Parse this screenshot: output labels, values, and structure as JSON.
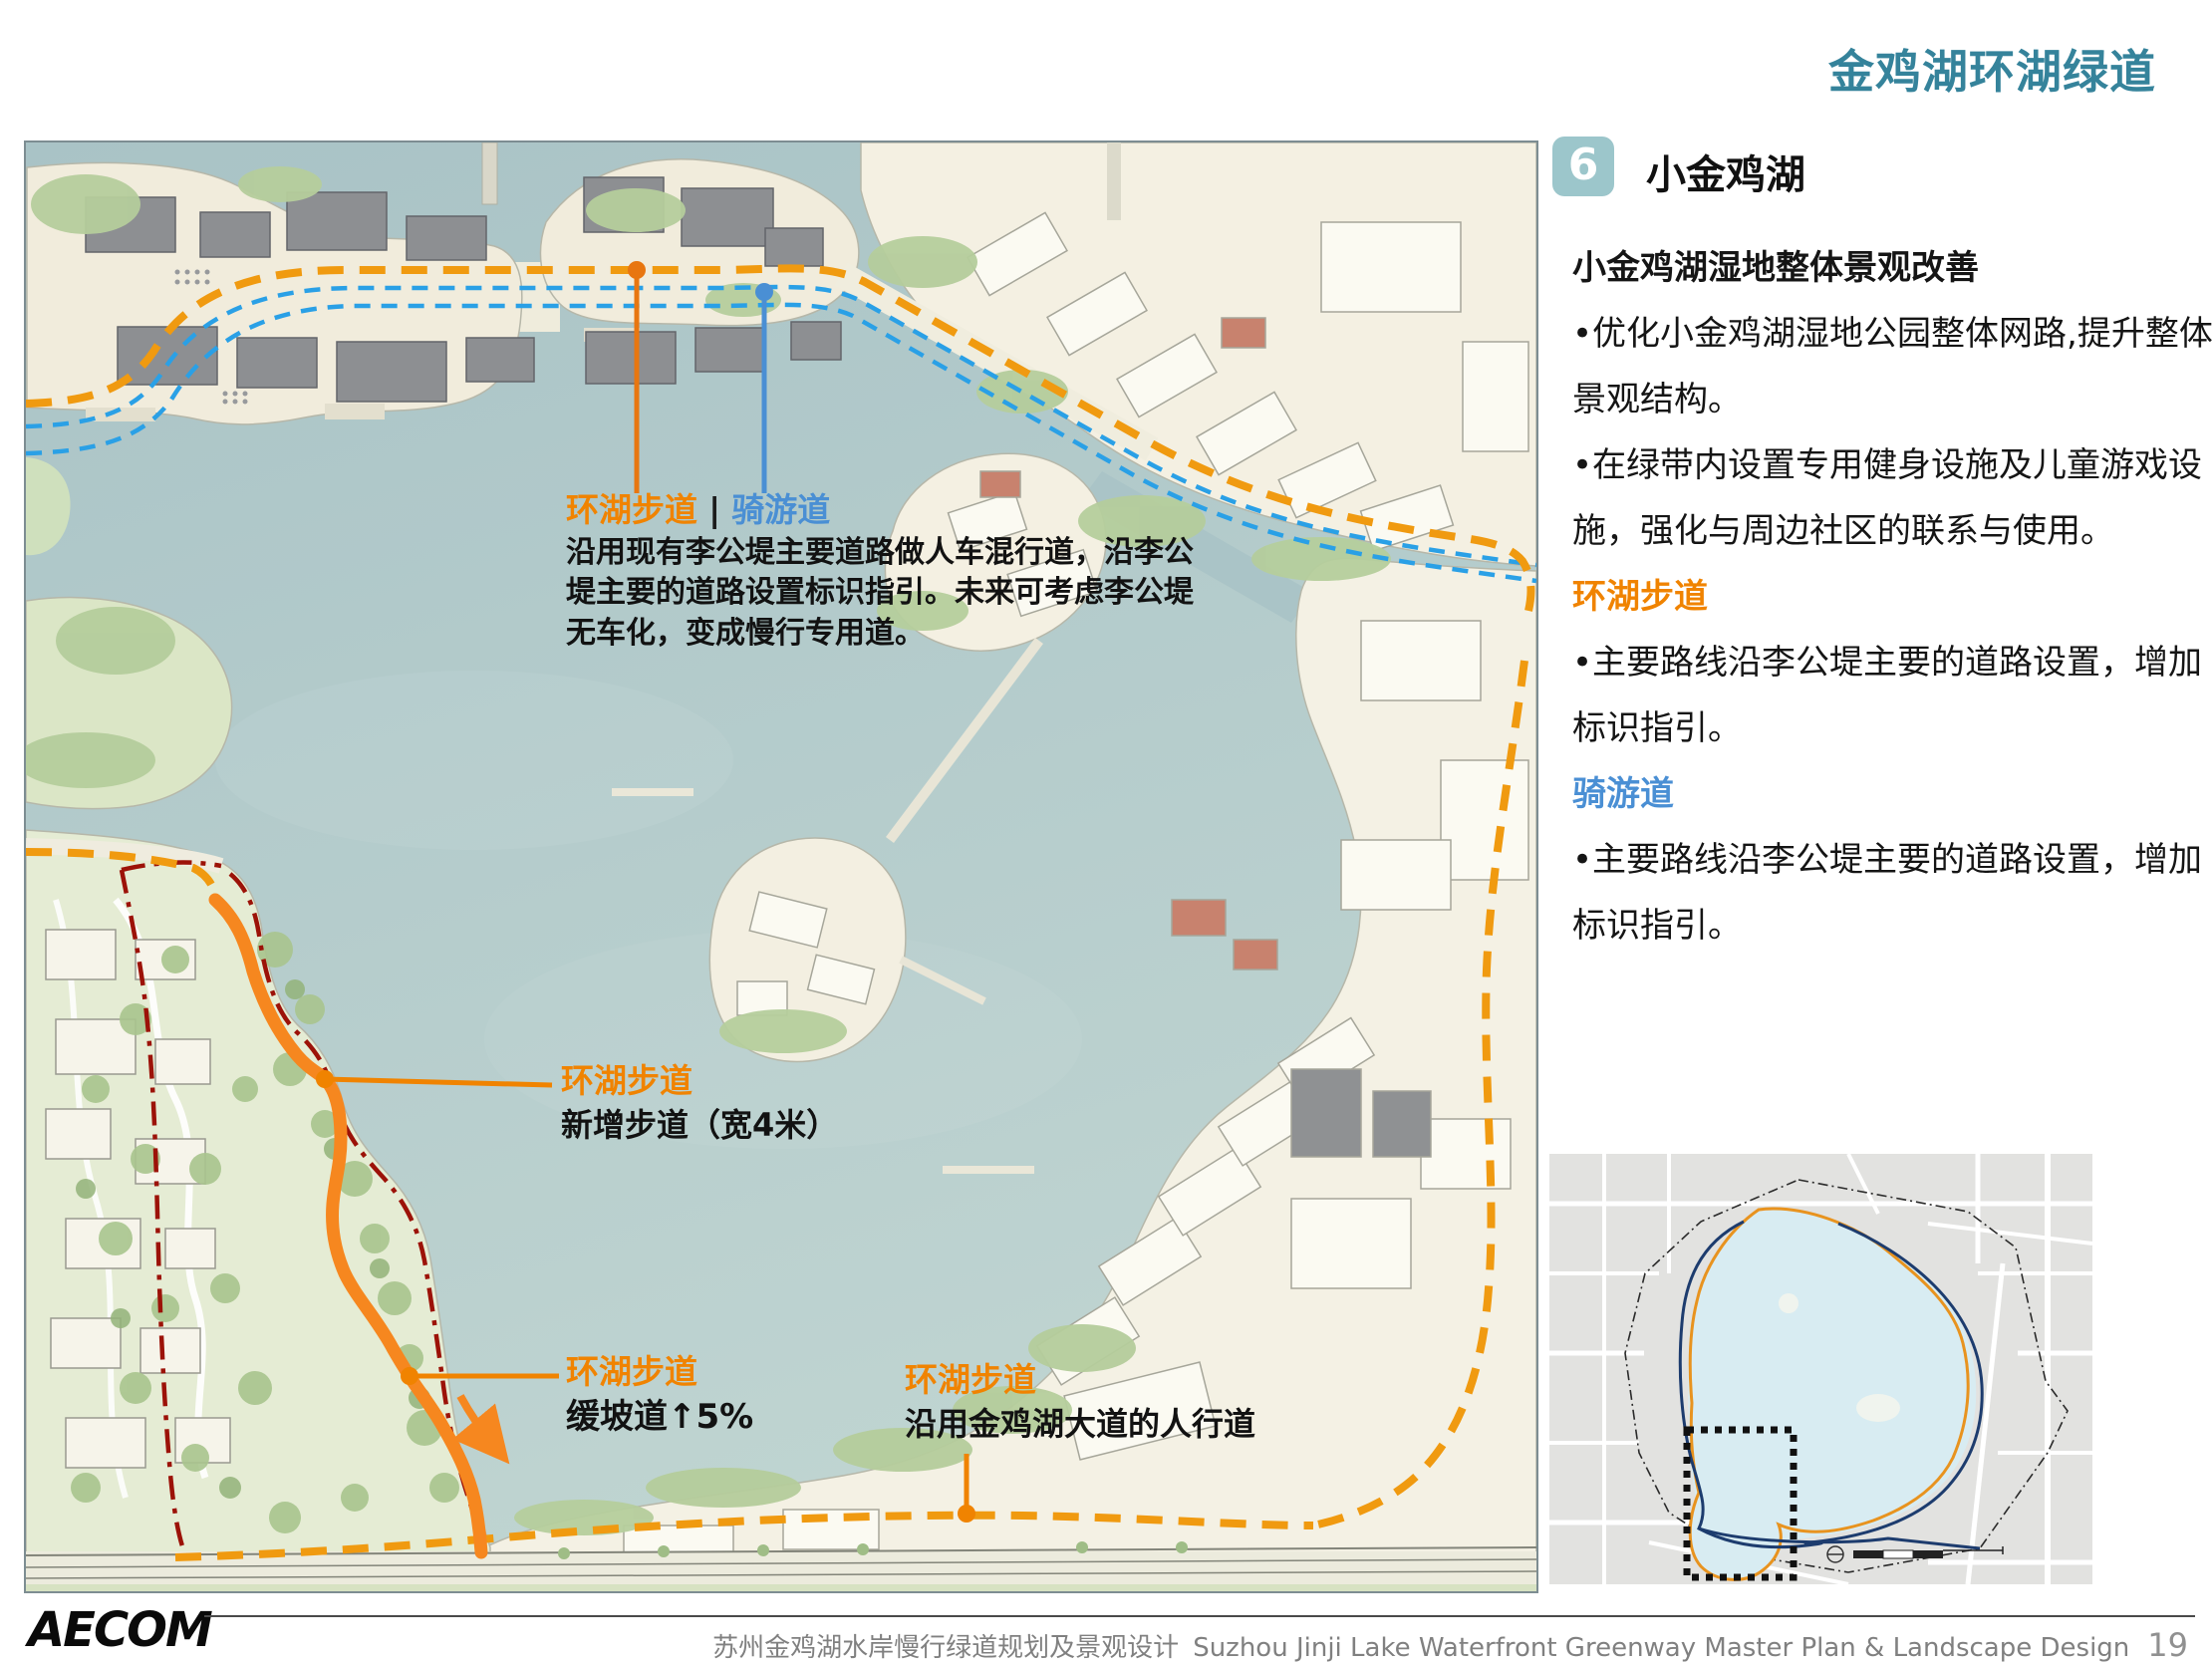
{
  "page_title": "金鸡湖环湖绿道",
  "section": {
    "number": "6",
    "title": "小金鸡湖"
  },
  "panel": {
    "heading": "小金鸡湖湿地整体景观改善",
    "bullet1": "•优化小金鸡湖湿地公园整体网路,提升整体景观结构。",
    "bullet2": "•在绿带内设置专用健身设施及儿童游戏设施，强化与周边社区的联系与使用。",
    "walkway_label": "环湖步道",
    "walkway_bullet": "•主要路线沿李公堤主要的道路设置，增加标识指引。",
    "bikeway_label": "骑游道",
    "bikeway_bullet": "•主要路线沿李公堤主要的道路设置，增加标识指引。"
  },
  "map_annotations": {
    "causeway": {
      "walkway": "环湖步道",
      "divider": "|",
      "bikeway": "骑游道",
      "body": "沿用现有李公堤主要道路做人车混行道，沿李公堤主要的道路设置标识指引。未来可考虑李公堤无车化，变成慢行专用道。"
    },
    "new_path": {
      "title": "环湖步道",
      "body": "新增步道（宽4米）"
    },
    "ramp": {
      "title": "环湖步道",
      "body": "缓坡道↑5%"
    },
    "sidewalk": {
      "title": "环湖步道",
      "body": "沿用金鸡湖大道的人行道"
    }
  },
  "footer": {
    "logo": "AECOM",
    "project_zh": "苏州金鸡湖水岸慢行绿道规划及景观设计",
    "project_en": "Suzhou Jinji Lake Waterfront Greenway  Master Plan & Landscape Design",
    "page_number": "19"
  },
  "colors": {
    "title_teal": "#35839b",
    "section_box_teal": "#9cc6cb",
    "walkway_orange": "#f08300",
    "bikeway_blue": "#4a8fd4",
    "route_orange": "#f09a10",
    "route_blue": "#2aa0e6",
    "boundary_red": "#9c1208",
    "water": "#aec7c9"
  }
}
